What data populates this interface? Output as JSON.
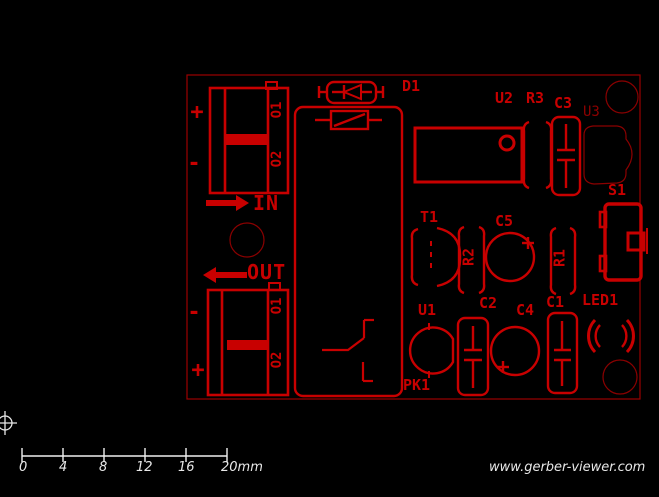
{
  "viewer": {
    "watermark": "www.gerber-viewer.com",
    "ruler": {
      "tick_labels": [
        "0",
        "4",
        "8",
        "12",
        "16",
        "20mm"
      ]
    },
    "colors": {
      "background": "#000000",
      "silkscreen": "#c80000",
      "board_outline": "#9b0000",
      "dim_outline": "#8b0000",
      "ruler": "#f0f0f0"
    }
  },
  "board": {
    "refdes": {
      "d1": "D1",
      "u2": "U2",
      "r3": "R3",
      "c3": "C3",
      "u3": "U3",
      "s1": "S1",
      "t1": "T1",
      "r2": "R2",
      "c5": "C5",
      "r1": "R1",
      "u1": "U1",
      "c2": "C2",
      "c4": "C4",
      "c1": "C1",
      "led1": "LED1",
      "pk1": "PK1"
    },
    "ports": {
      "in": "IN",
      "out": "OUT"
    },
    "connector_top": {
      "pin1": "O1",
      "pin2": "O2",
      "plus": "+",
      "minus": "-"
    },
    "connector_bottom": {
      "pin1": "O1",
      "pin2": "O2",
      "plus": "+",
      "minus": "-"
    }
  }
}
